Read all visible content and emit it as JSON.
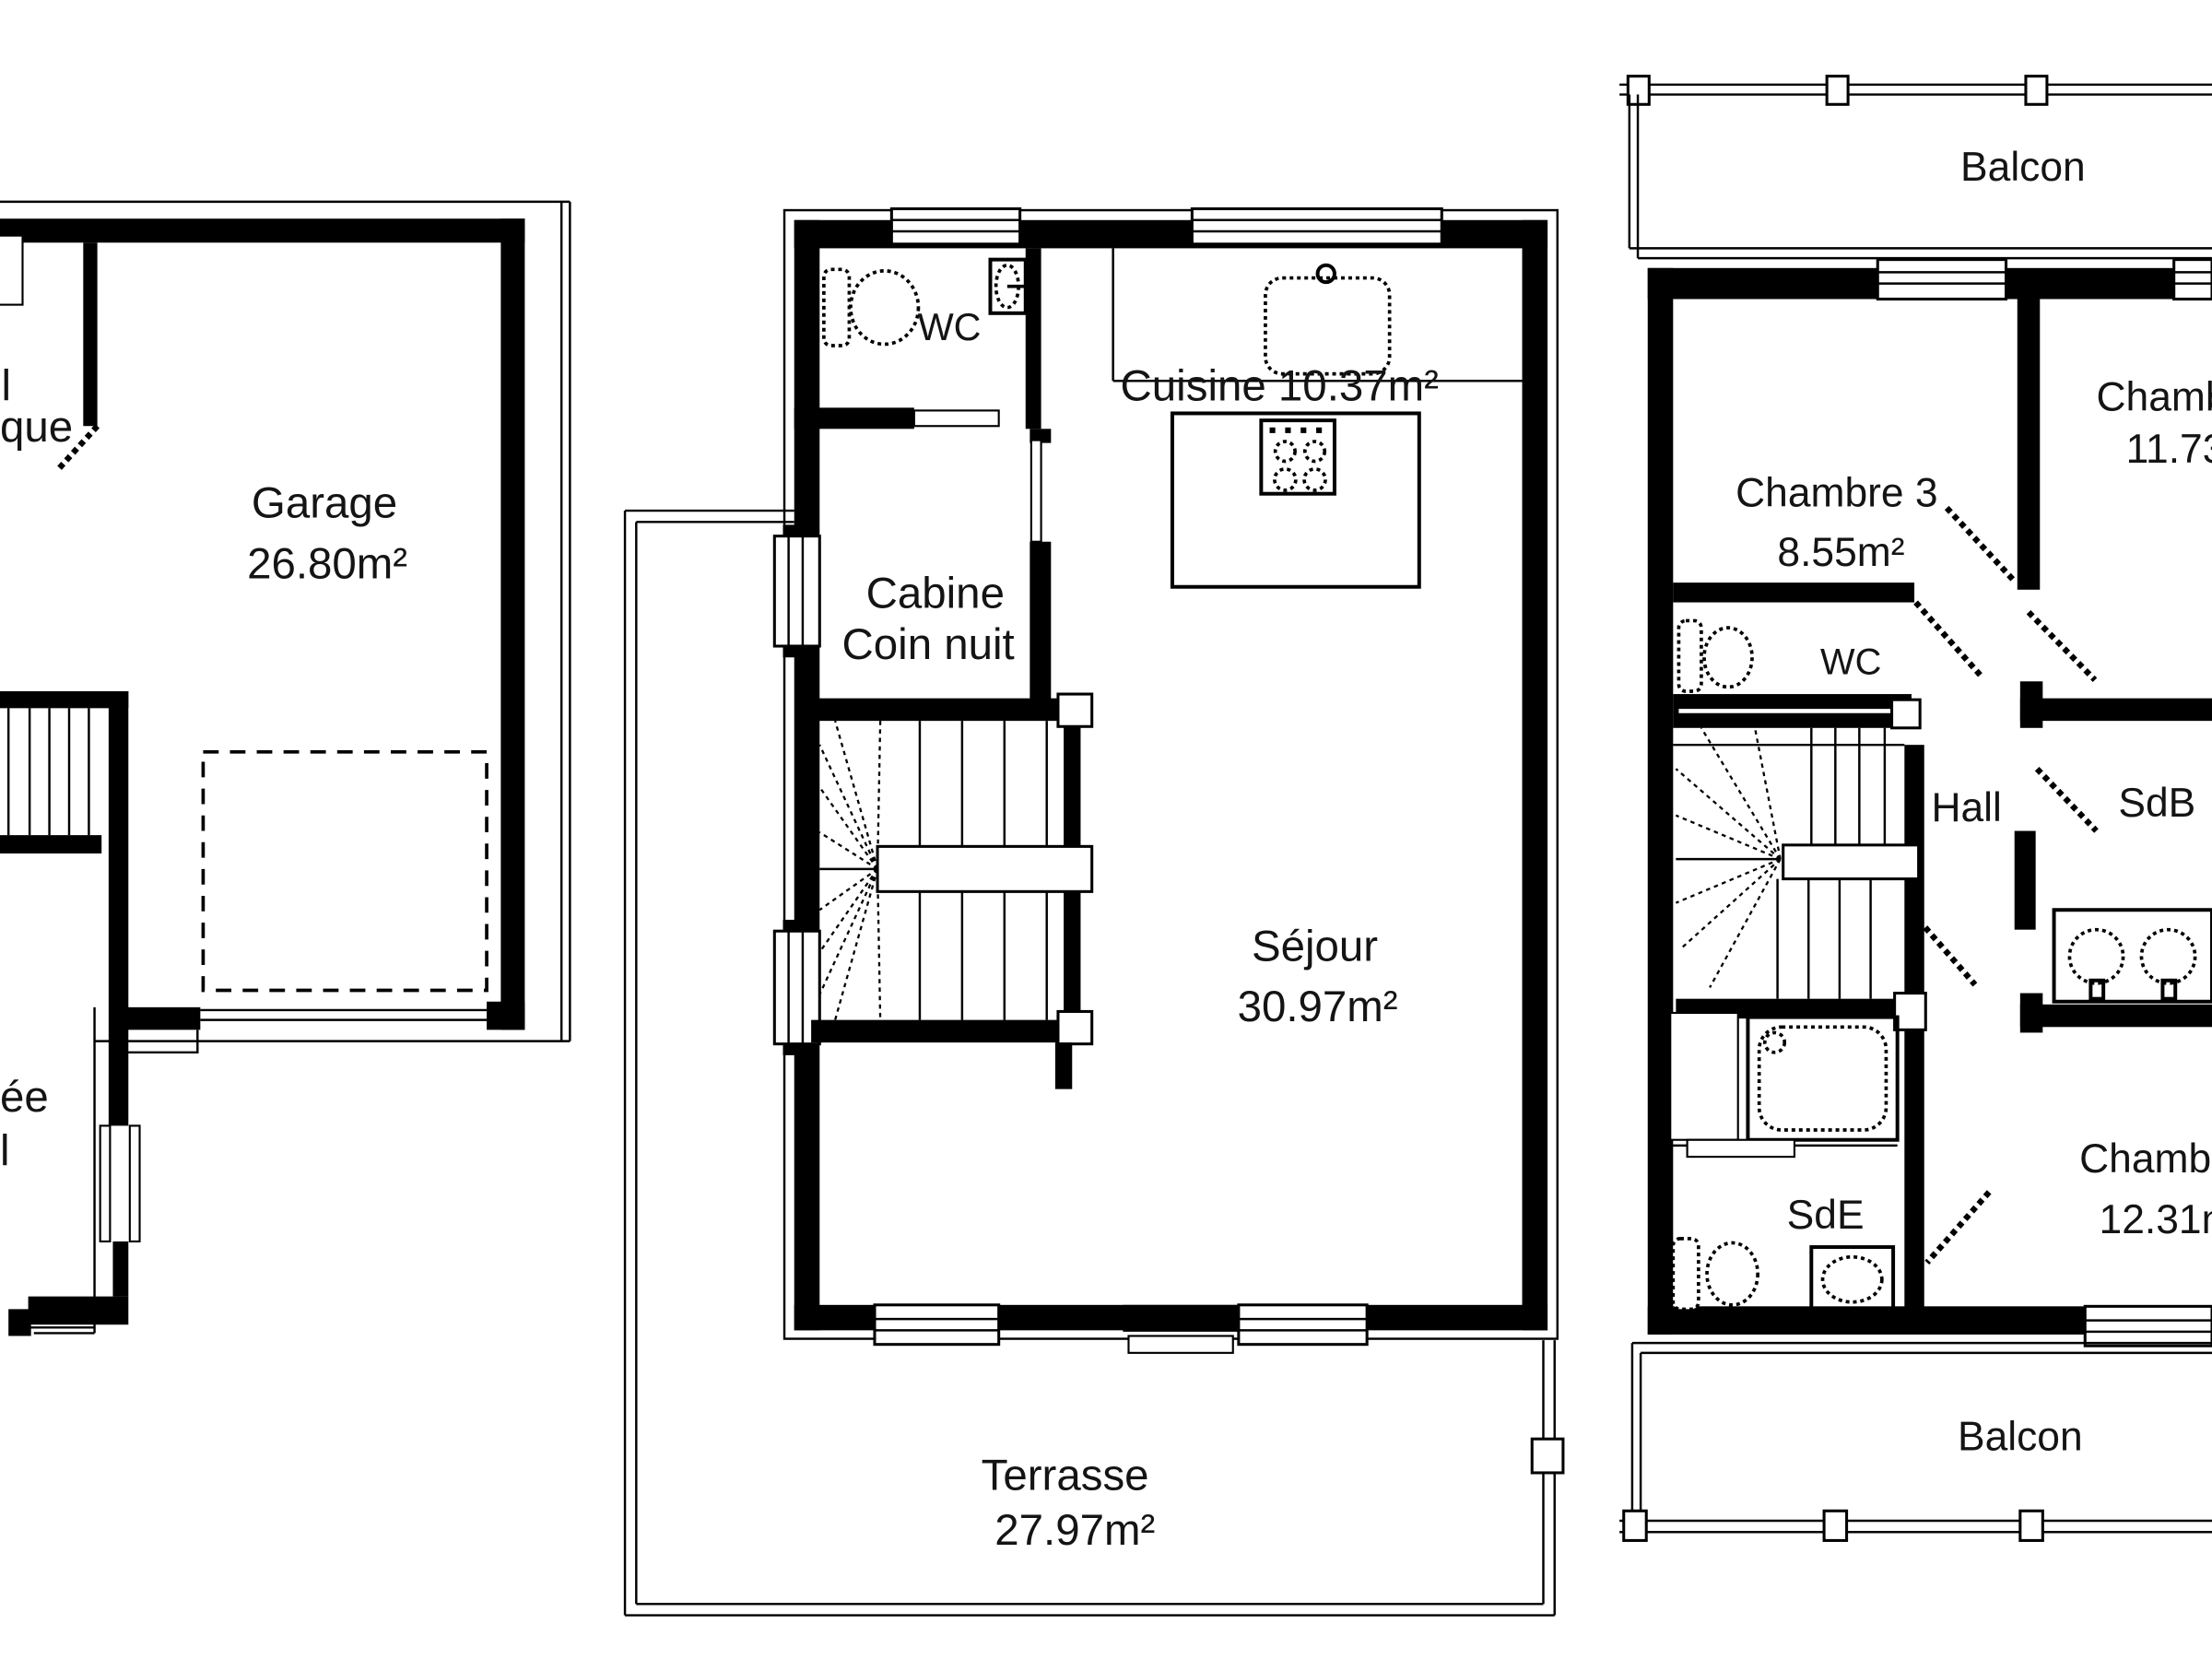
{
  "document": {
    "type": "architectural floor plan",
    "units": "m²"
  },
  "colors": {
    "wall": "#000000",
    "background": "#ffffff",
    "text": "#141414"
  },
  "plans": {
    "left": {
      "clipped_top_line1": "l",
      "clipped_top_line2": "que",
      "garage_name": "Garage",
      "garage_area": "26.80m²",
      "clipped_bottom_line1": "ée",
      "clipped_bottom_line2": "l"
    },
    "middle": {
      "wc": "WC",
      "cabine_line1": "Cabine",
      "cabine_line2": "Coin nuit",
      "cuisine_label": "Cuisine 10.37m²",
      "sejour_name": "Séjour",
      "sejour_area": "30.97m²",
      "terrasse_name": "Terrasse",
      "terrasse_area": "27.97m²"
    },
    "right": {
      "balcon_top": "Balcon",
      "balcon_bottom": "Balcon",
      "chambre3_name": "Chambre 3",
      "chambre3_area": "8.55m²",
      "chambre2_name_clipped": "Chamb",
      "chambre2_area_clipped": "11.73",
      "wc": "WC",
      "sdb": "SdB",
      "hall": "Hall",
      "sde": "SdE",
      "chambre1_name_clipped": "Chambr",
      "chambre1_area_clipped": "12.31m"
    }
  }
}
